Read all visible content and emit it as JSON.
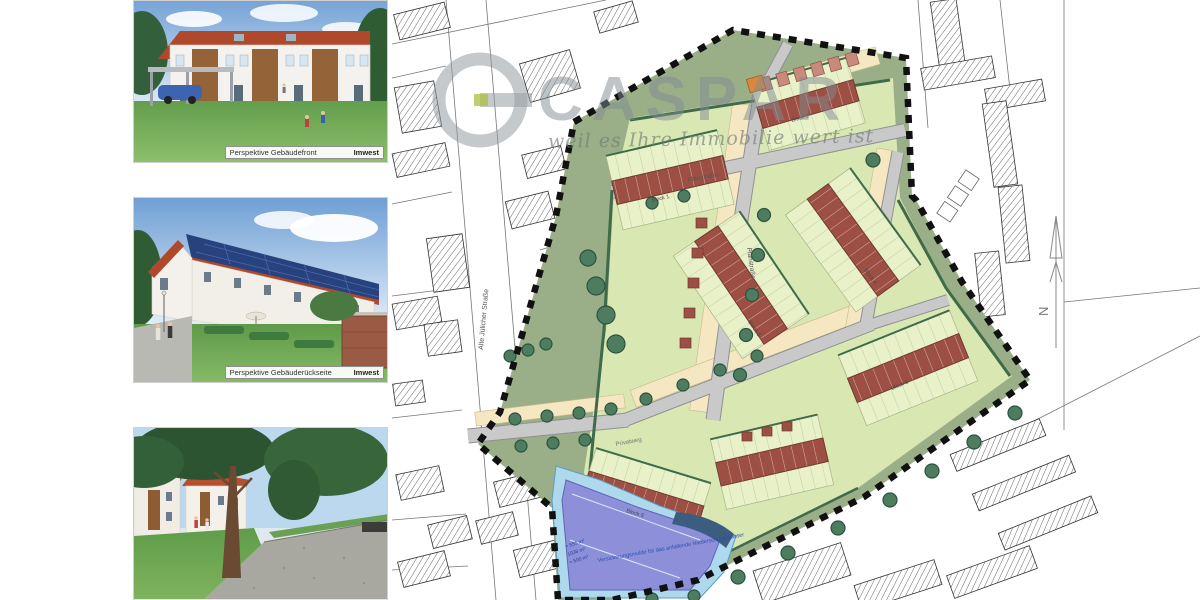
{
  "watermark": {
    "brand": "CASPAR",
    "slogan": "weil es Ihre Immobilie wert ist"
  },
  "gallery": {
    "items": [
      {
        "caption": "Perspektive Gebäudefront",
        "credit": "Imwest"
      },
      {
        "caption": "Perspektive Gebäuderückseite",
        "credit": "Imwest"
      },
      {
        "caption": "",
        "credit": ""
      }
    ]
  },
  "site_plan": {
    "labels": {
      "street_west": "Alte Jülicher Straße",
      "plan_road_north": "Planstraße",
      "plan_road_spine": "Planstraße",
      "path_south": "Privatweg",
      "north_arrow": "N",
      "basin_note": "Versickerungsmulde für das anfallende Niederschlagswasser",
      "basin_area_1": "≈ 555 m²",
      "basin_area_2": "1038 m²",
      "basin_area_3": "≈ 500 m²",
      "blocks": [
        "Block 1",
        "Block 2",
        "Block 3",
        "Block 4",
        "Block 5",
        "Block 6"
      ]
    },
    "colors": {
      "house_roof": "#9d4f43",
      "garden": "#e9f1c9",
      "meadow": "#9aaf88",
      "road": "#c9c9ca",
      "tree": "#4d7c5e",
      "basin_fill": "#8d90d8",
      "basin_edge": "#aee0f2",
      "boundary": "#111111",
      "parking_strip": "#f6e7c3",
      "highlight_orange": "#d9883c"
    }
  }
}
